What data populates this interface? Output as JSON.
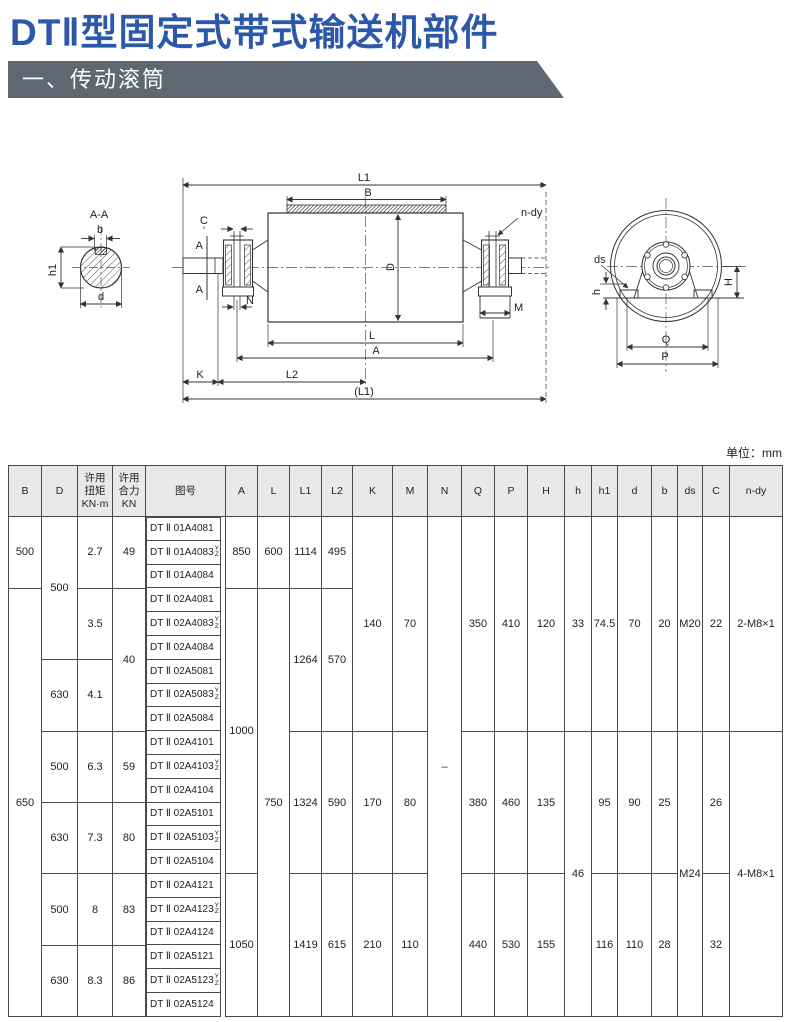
{
  "page": {
    "title": "DTⅡ型固定式带式输送机部件",
    "section_header": "一、传动滚筒",
    "unit_note": "单位：mm"
  },
  "colors": {
    "title_blue": "#2b58a8",
    "banner_gray": "#5d6873",
    "table_header_bg": "#e9e9e9",
    "table_border": "#4a4a4a"
  },
  "drawing": {
    "section_label": "A-A",
    "dims": {
      "b": "b",
      "h1": "h1",
      "d": "d",
      "L1": "L1",
      "B": "B",
      "C": "C",
      "A_marker": "A",
      "N": "N",
      "n_dy": "n-dy",
      "M": "M",
      "D": "D",
      "L": "L",
      "A": "A",
      "K": "K",
      "L2": "L2",
      "L1_paren": "(L1)",
      "ds": "ds",
      "h": "h",
      "H": "H",
      "Q": "Q",
      "P": "P"
    }
  },
  "table": {
    "columns": [
      "B",
      "D",
      "许用\n扭矩\nKN·m",
      "许用\n合力\nKN",
      "图号",
      "A",
      "L",
      "L1",
      "L2",
      "K",
      "M",
      "N",
      "Q",
      "P",
      "H",
      "h",
      "h1",
      "d",
      "b",
      "ds",
      "C",
      "n-dy"
    ],
    "cells": {
      "B": [
        "500",
        "650"
      ],
      "D": [
        "500",
        "630",
        "500",
        "630",
        "500",
        "630"
      ],
      "torque": [
        "2.7",
        "3.5",
        "4.1",
        "6.3",
        "7.3",
        "8",
        "8.3"
      ],
      "force": [
        "49",
        "40",
        "59",
        "80",
        "83",
        "86"
      ],
      "A": [
        "850",
        "1000",
        "1050"
      ],
      "L": [
        "600",
        "750"
      ],
      "L1": [
        "1114",
        "1264",
        "1324",
        "1419"
      ],
      "L2": [
        "495",
        "570",
        "590",
        "615"
      ],
      "K": [
        "140",
        "170",
        "210"
      ],
      "M": [
        "70",
        "80",
        "110"
      ],
      "N": [
        "–"
      ],
      "Q": [
        "350",
        "380",
        "440"
      ],
      "P": [
        "410",
        "460",
        "530"
      ],
      "H": [
        "120",
        "135",
        "155"
      ],
      "h": [
        "33",
        "46"
      ],
      "h1": [
        "74.5",
        "95",
        "116"
      ],
      "d": [
        "70",
        "90",
        "110"
      ],
      "b": [
        "20",
        "25",
        "28"
      ],
      "ds": [
        "M20",
        "M24"
      ],
      "C": [
        "22",
        "26",
        "32"
      ],
      "ndy": [
        "2-M8×1",
        "4-M8×1"
      ]
    },
    "tuhao": [
      {
        "text": "DT Ⅱ 01A4081"
      },
      {
        "text": "DT Ⅱ 01A4083",
        "yz_top": "Y",
        "yz_bottom": "Z"
      },
      {
        "text": "DT Ⅱ 01A4084"
      },
      {
        "text": "DT Ⅱ 02A4081"
      },
      {
        "text": "DT Ⅱ 02A4083",
        "yz_top": "Y",
        "yz_bottom": "Z"
      },
      {
        "text": "DT Ⅱ 02A4084"
      },
      {
        "text": "DT Ⅱ 02A5081"
      },
      {
        "text": "DT Ⅱ 02A5083",
        "yz_top": "Y",
        "yz_bottom": "Z"
      },
      {
        "text": "DT Ⅱ 02A5084"
      },
      {
        "text": "DT Ⅱ 02A4101"
      },
      {
        "text": "DT Ⅱ 02A4103",
        "yz_top": "Y",
        "yz_bottom": "Z"
      },
      {
        "text": "DT Ⅱ 02A4104"
      },
      {
        "text": "DT Ⅱ 02A5101"
      },
      {
        "text": "DT Ⅱ 02A5103",
        "yz_top": "Y",
        "yz_bottom": "Z"
      },
      {
        "text": "DT Ⅱ 02A5104"
      },
      {
        "text": "DT Ⅱ 02A4121"
      },
      {
        "text": "DT Ⅱ 02A4123",
        "yz_top": "Y",
        "yz_bottom": "Z"
      },
      {
        "text": "DT Ⅱ 02A4124"
      },
      {
        "text": "DT Ⅱ 02A5121"
      },
      {
        "text": "DT Ⅱ 02A5123",
        "yz_top": "Y",
        "yz_bottom": "Z"
      },
      {
        "text": "DT Ⅱ 02A5124"
      }
    ]
  }
}
